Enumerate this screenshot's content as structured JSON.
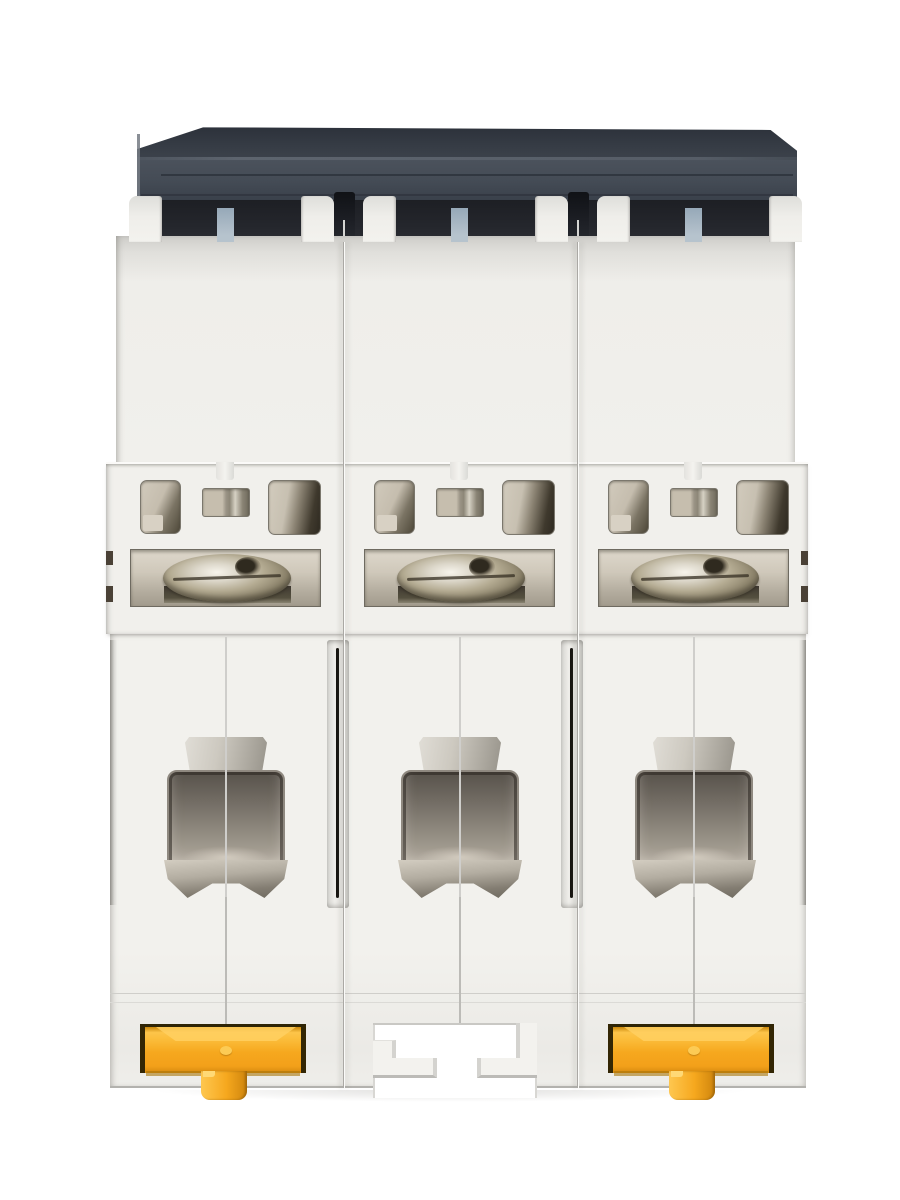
{
  "scene": {
    "type": "product-photo",
    "subject": "Three-pole miniature circuit breaker, rear DIN-rail side view",
    "background": "#ffffff",
    "visible_text": ""
  },
  "device": {
    "module_count": 3,
    "parts": {
      "cap": "dark housing cap",
      "blue_tab": "blue latch tab",
      "white_tab": "white corner tab",
      "vents": "ventilation openings",
      "screw_window": "screw inspection window",
      "screw": "slotted terminal screw",
      "terminal": "wire terminal opening",
      "clamp": "terminal clamp plate",
      "seam_slot": "inter-pole groove",
      "din_clip": "yellow DIN-rail release clip",
      "din_slot": "DIN-rail slot with hooks"
    }
  },
  "modules": [
    {
      "name": "pole-1",
      "bottom": "din-clip"
    },
    {
      "name": "pole-2",
      "bottom": "din-rail-slot"
    },
    {
      "name": "pole-3",
      "bottom": "din-clip"
    }
  ],
  "colors": {
    "background": "#ffffff",
    "cap_dark": "#343a42",
    "cap_face": "#454c56",
    "recess": "#222429",
    "blue_tab": "#96a8b8",
    "body_white": "#f1f0ec",
    "body_shadow": "#d6d5d1",
    "vent_beige": "#c8c0b1",
    "vent_shadow": "#473f31",
    "metal_light": "#e8e4da",
    "metal_mid": "#a39c8a",
    "metal_dark": "#5f5847",
    "terminal_divider": "#2b2722",
    "clip_yellow": "#f6a81e",
    "clip_yellow_light": "#ffd061",
    "clip_frame": "#332604"
  }
}
